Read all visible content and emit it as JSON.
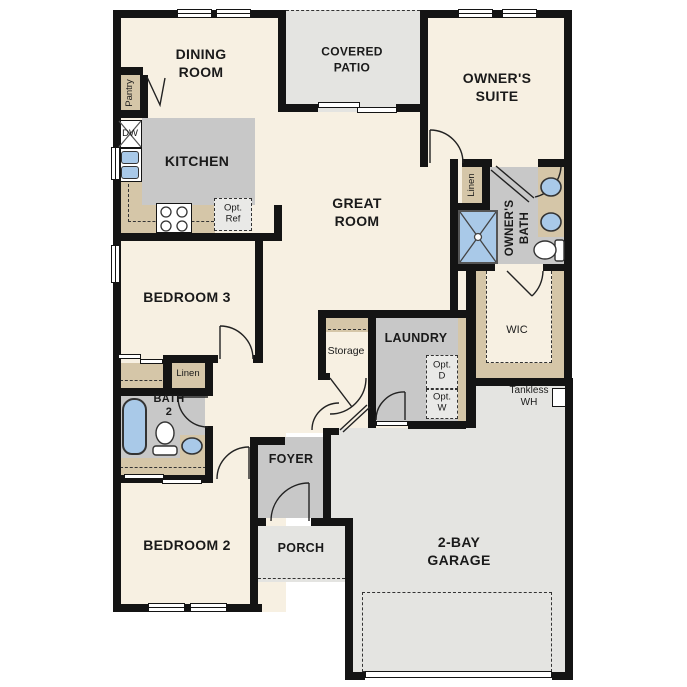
{
  "labels": {
    "dining_room": "DINING\nROOM",
    "covered_patio": "COVERED\nPATIO",
    "owners_suite": "OWNER'S\nSUITE",
    "kitchen": "KITCHEN",
    "great_room": "GREAT\nROOM",
    "bedroom_3": "BEDROOM 3",
    "owners_bath": "OWNER'S\nBATH",
    "linen_owner": "Linen",
    "wic": "WIC",
    "pantry": "Pantry",
    "dishwasher": "DW",
    "opt_ref": "Opt.\nRef",
    "storage": "Storage",
    "laundry": "LAUNDRY",
    "opt_dryer": "Opt.\nD",
    "opt_washer": "Opt.\nW",
    "tankless_wh": "Tankless\nWH",
    "linen_hall": "Linen",
    "bath_2": "BATH\n2",
    "bedroom_2": "BEDROOM 2",
    "foyer": "FOYER",
    "porch": "PORCH",
    "garage": "2-BAY\nGARAGE"
  },
  "colors": {
    "wall": "#141414",
    "floor": "#f7f0e2",
    "room_gray": "#c8c8c8",
    "outdoor_gray": "#e4e4e1",
    "cabinet_tan": "#d5c6a8",
    "fixture_blue": "#a9c9e8",
    "optional_fill": "#e9e9e7"
  }
}
